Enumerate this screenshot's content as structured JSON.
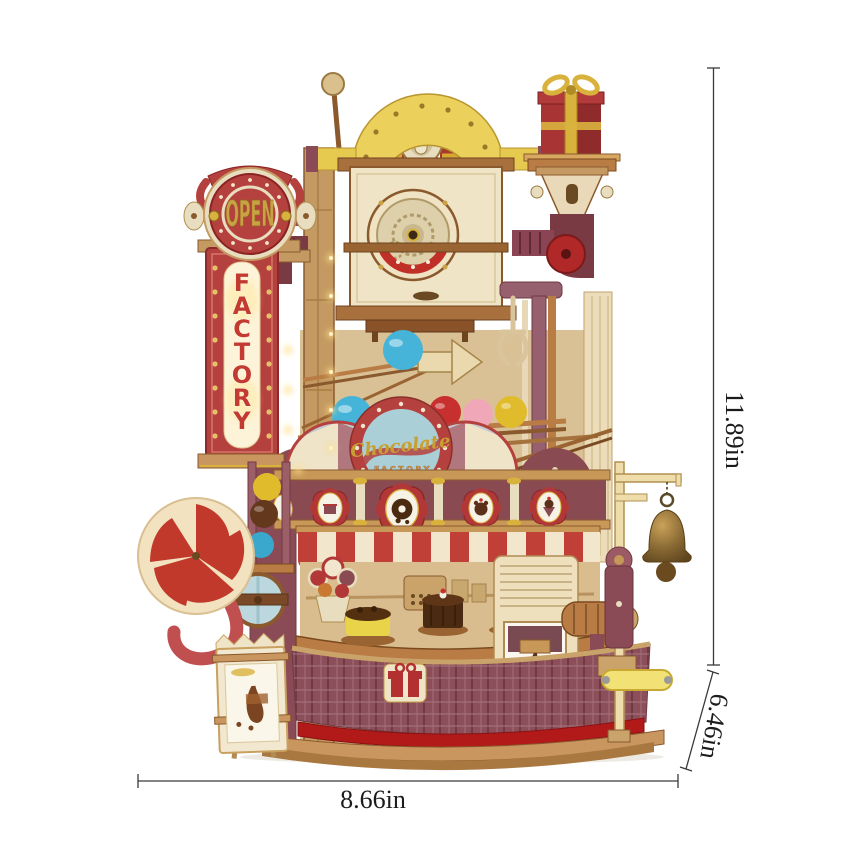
{
  "figure": {
    "type": "product-dimension-photo",
    "subject": "wooden chocolate factory marble run model kit with measurement annotations"
  },
  "dimensions": {
    "height": {
      "label": "11.89in",
      "orientation": "vertical-right"
    },
    "width": {
      "label": "8.66in",
      "orientation": "horizontal-bottom"
    },
    "depth": {
      "label": "6.46in",
      "orientation": "diagonal-lower-right"
    }
  },
  "model": {
    "open_sign_text": "OPEN",
    "factory_sign_letters": [
      "F",
      "A",
      "C",
      "T",
      "O",
      "R",
      "Y"
    ],
    "badge": {
      "line1": "Chocolate",
      "line2": "FACTORY"
    }
  },
  "colors": {
    "dimension_line": "#3a3a3a",
    "dimension_text": "#1c1c1c",
    "sign_red": "#b5413f",
    "cream_wood": "#f0e4c6",
    "mid_wood": "#c49a62",
    "dark_wood": "#8a5a2e",
    "maroon": "#8a4a56",
    "arch_yellow": "#ecd05c",
    "badge_blue": "#aacfd6",
    "gold": "#c9a243",
    "awning_red": "#c04038",
    "carpet_red": "#b21a1a",
    "ball_blue": "#45b4d8",
    "ball_red": "#c83030",
    "ball_pink": "#f0a8b8",
    "ball_yellow": "#e0bc2c",
    "ball_brown": "#63381c",
    "bell_bronze": "#8a6a34"
  }
}
